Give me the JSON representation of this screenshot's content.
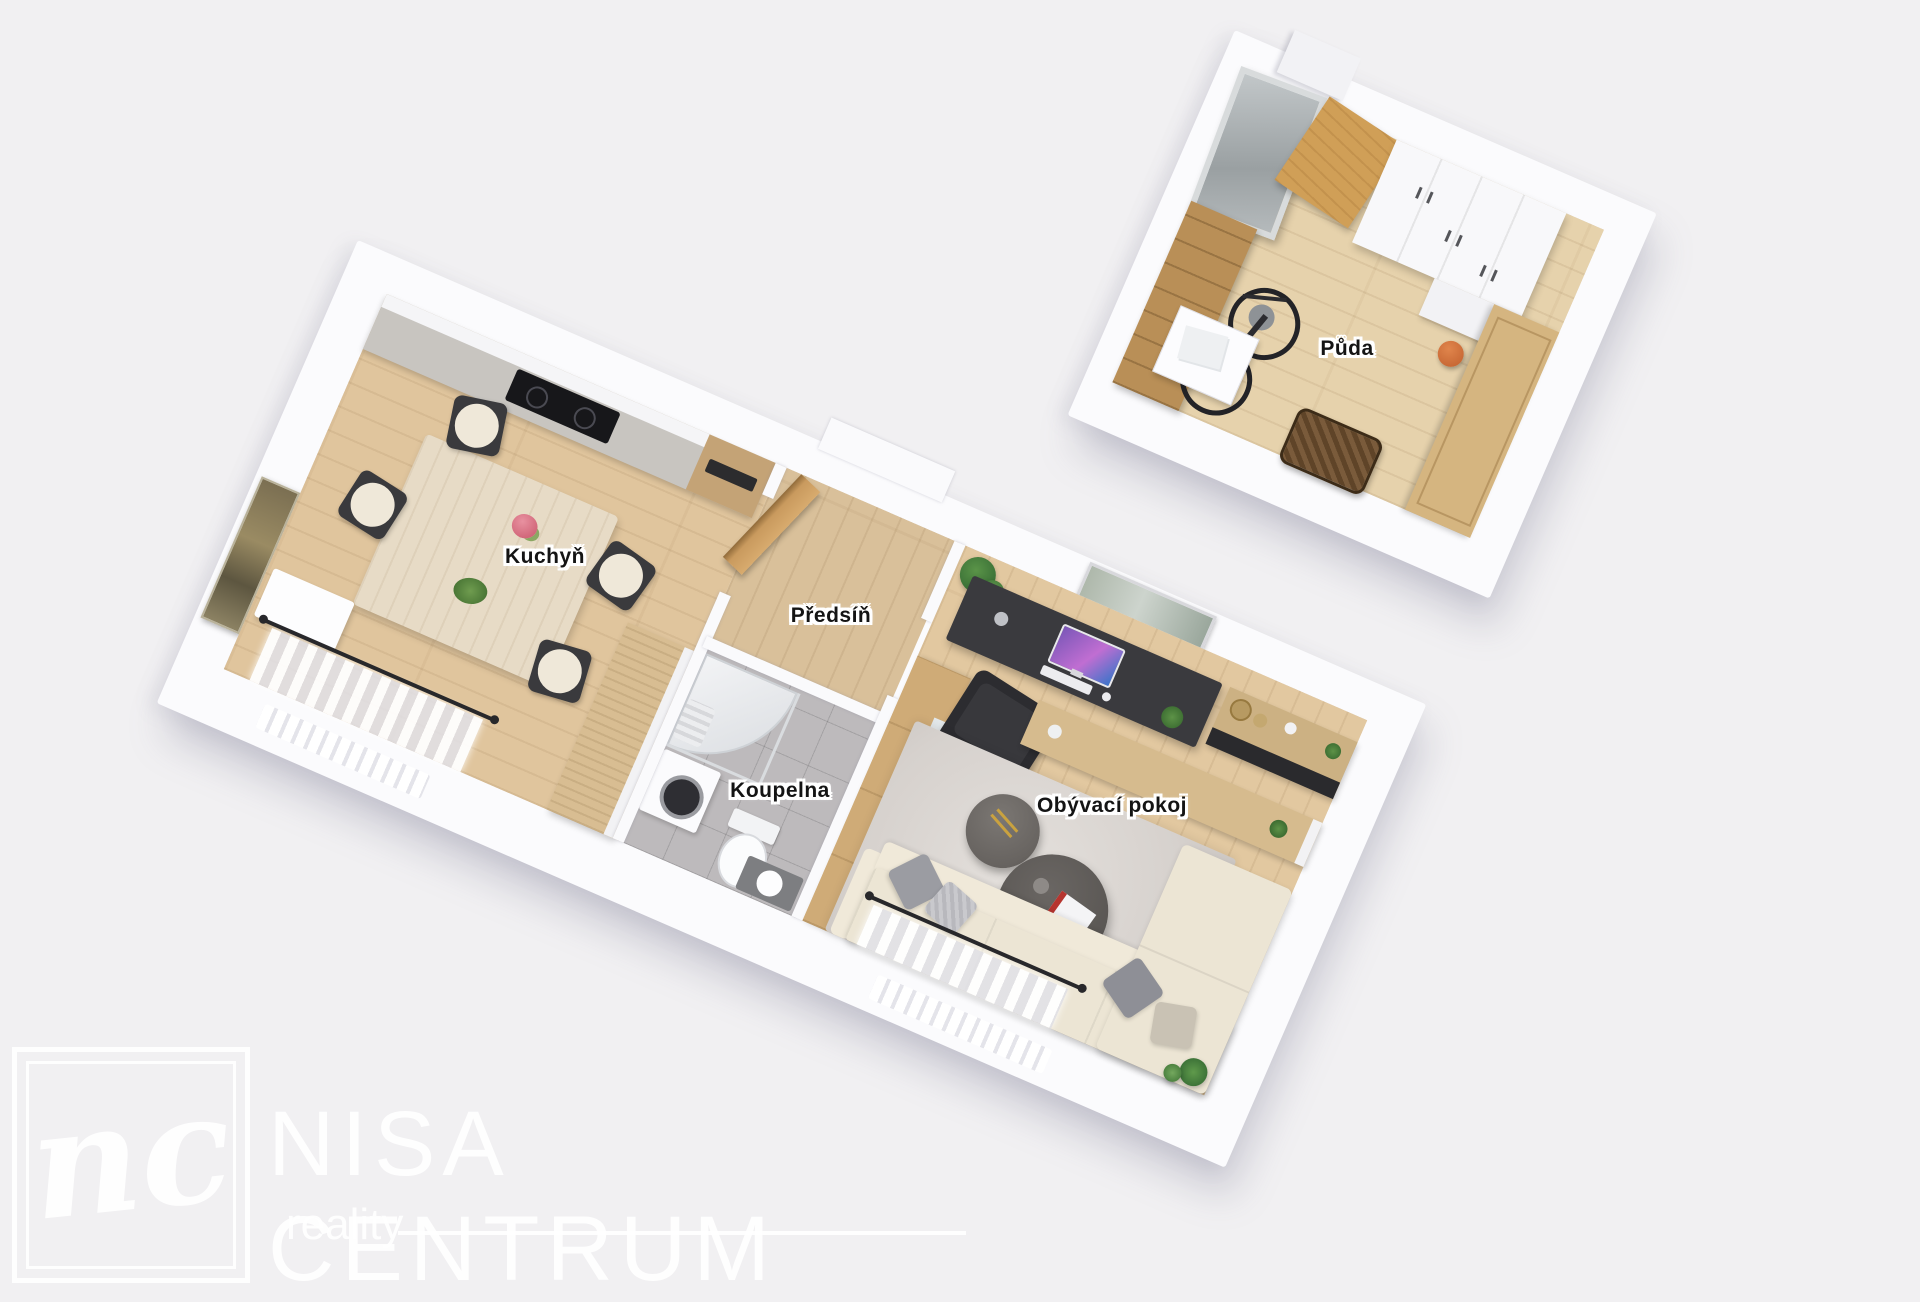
{
  "scene": {
    "type": "3d-floorplan-render",
    "background_color": "#f1f0f2",
    "wall_color": "#fafafc",
    "wood_floor_color": "#e0c59d",
    "bathroom_tile_color": "#bdbabc",
    "label_text_color": "#141414",
    "label_halo_color": "#ffffff"
  },
  "rooms": {
    "kitchen": {
      "label": "Kuchyň"
    },
    "hallway": {
      "label": "Předsíň"
    },
    "bathroom": {
      "label": "Koupelna"
    },
    "living_room": {
      "label": "Obývací pokoj"
    },
    "attic": {
      "label": "Půda"
    }
  },
  "watermark": {
    "monogram": "nc",
    "brand": "NISA CENTRUM",
    "tagline": "reality",
    "color": "#ffffff"
  }
}
